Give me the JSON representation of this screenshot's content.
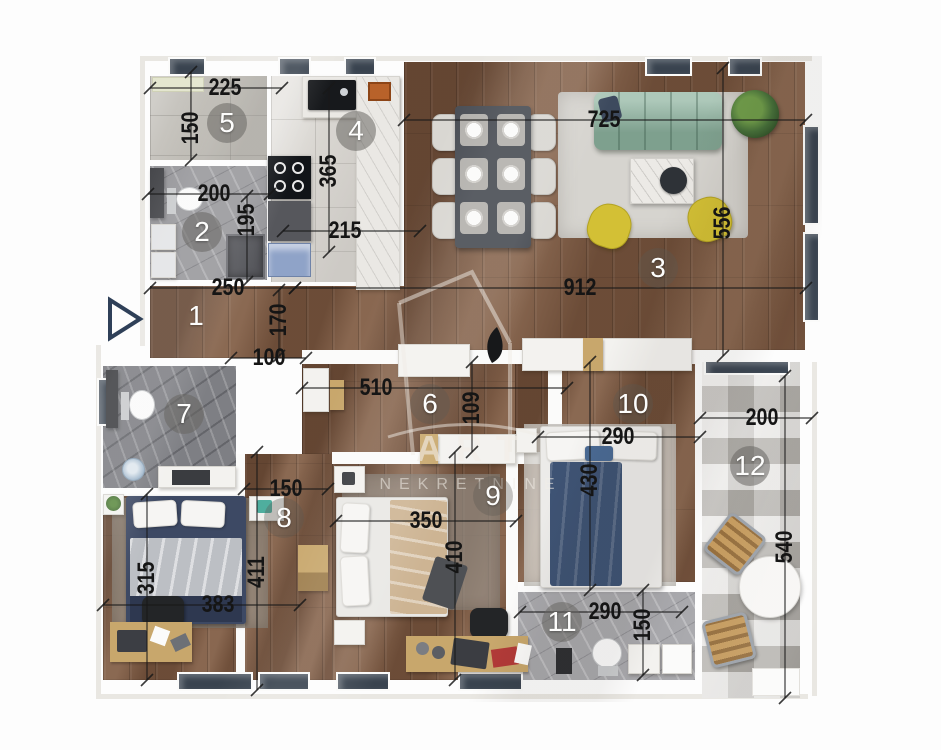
{
  "watermark": {
    "line1": "ART",
    "line2": "NEKRETNINE"
  },
  "room_numbers": [
    {
      "n": "1",
      "x": 196,
      "y": 316,
      "tier": "none"
    },
    {
      "n": "2",
      "x": 202,
      "y": 232,
      "tier": "strong"
    },
    {
      "n": "3",
      "x": 658,
      "y": 268,
      "tier": "soft"
    },
    {
      "n": "4",
      "x": 356,
      "y": 131,
      "tier": "strong"
    },
    {
      "n": "5",
      "x": 227,
      "y": 123,
      "tier": "strong"
    },
    {
      "n": "6",
      "x": 430,
      "y": 404,
      "tier": "soft"
    },
    {
      "n": "7",
      "x": 184,
      "y": 414,
      "tier": "strong"
    },
    {
      "n": "8",
      "x": 284,
      "y": 518,
      "tier": "soft"
    },
    {
      "n": "9",
      "x": 493,
      "y": 496,
      "tier": "soft"
    },
    {
      "n": "10",
      "x": 633,
      "y": 404,
      "tier": "soft"
    },
    {
      "n": "11",
      "x": 562,
      "y": 622,
      "tier": "strong"
    },
    {
      "n": "12",
      "x": 750,
      "y": 466,
      "tier": "strong"
    }
  ],
  "dimension_labels": [
    {
      "v": "225",
      "x": 225,
      "y": 88,
      "rot": 0
    },
    {
      "v": "150",
      "x": 191,
      "y": 128,
      "rot": 90
    },
    {
      "v": "200",
      "x": 214,
      "y": 194,
      "rot": 0
    },
    {
      "v": "195",
      "x": 247,
      "y": 220,
      "rot": 90
    },
    {
      "v": "365",
      "x": 329,
      "y": 171,
      "rot": 90
    },
    {
      "v": "215",
      "x": 345,
      "y": 231,
      "rot": 0
    },
    {
      "v": "725",
      "x": 604,
      "y": 120,
      "rot": 0
    },
    {
      "v": "556",
      "x": 723,
      "y": 223,
      "rot": 90
    },
    {
      "v": "250",
      "x": 228,
      "y": 288,
      "rot": 0
    },
    {
      "v": "912",
      "x": 580,
      "y": 288,
      "rot": 0
    },
    {
      "v": "170",
      "x": 279,
      "y": 320,
      "rot": 90
    },
    {
      "v": "100",
      "x": 269,
      "y": 358,
      "rot": 0
    },
    {
      "v": "510",
      "x": 376,
      "y": 388,
      "rot": 0
    },
    {
      "v": "109",
      "x": 472,
      "y": 408,
      "rot": 90
    },
    {
      "v": "290",
      "x": 618,
      "y": 437,
      "rot": 0
    },
    {
      "v": "430",
      "x": 590,
      "y": 480,
      "rot": 90
    },
    {
      "v": "350",
      "x": 426,
      "y": 521,
      "rot": 0
    },
    {
      "v": "410",
      "x": 455,
      "y": 557,
      "rot": 90
    },
    {
      "v": "150",
      "x": 286,
      "y": 489,
      "rot": 0
    },
    {
      "v": "315",
      "x": 147,
      "y": 578,
      "rot": 90
    },
    {
      "v": "411",
      "x": 257,
      "y": 572,
      "rot": 90
    },
    {
      "v": "383",
      "x": 218,
      "y": 605,
      "rot": 0
    },
    {
      "v": "290",
      "x": 605,
      "y": 612,
      "rot": 0
    },
    {
      "v": "150",
      "x": 643,
      "y": 625,
      "rot": 90
    },
    {
      "v": "200",
      "x": 762,
      "y": 418,
      "rot": 0
    },
    {
      "v": "540",
      "x": 785,
      "y": 547,
      "rot": 90
    }
  ],
  "colors": {
    "wood": "#7d5a43",
    "tile_light": "#d9d6d1",
    "tile_gray": "#bcb9b2",
    "marble": "#96969a",
    "window_navy": "#39434f",
    "sofa_green": "#9bbcaa",
    "chair_yellow": "#d3c035",
    "bed_navy": "#3e5374",
    "blanket_beige": "#cdb493",
    "accent_wood": "#c8a76c",
    "dim_text": "#151515"
  }
}
